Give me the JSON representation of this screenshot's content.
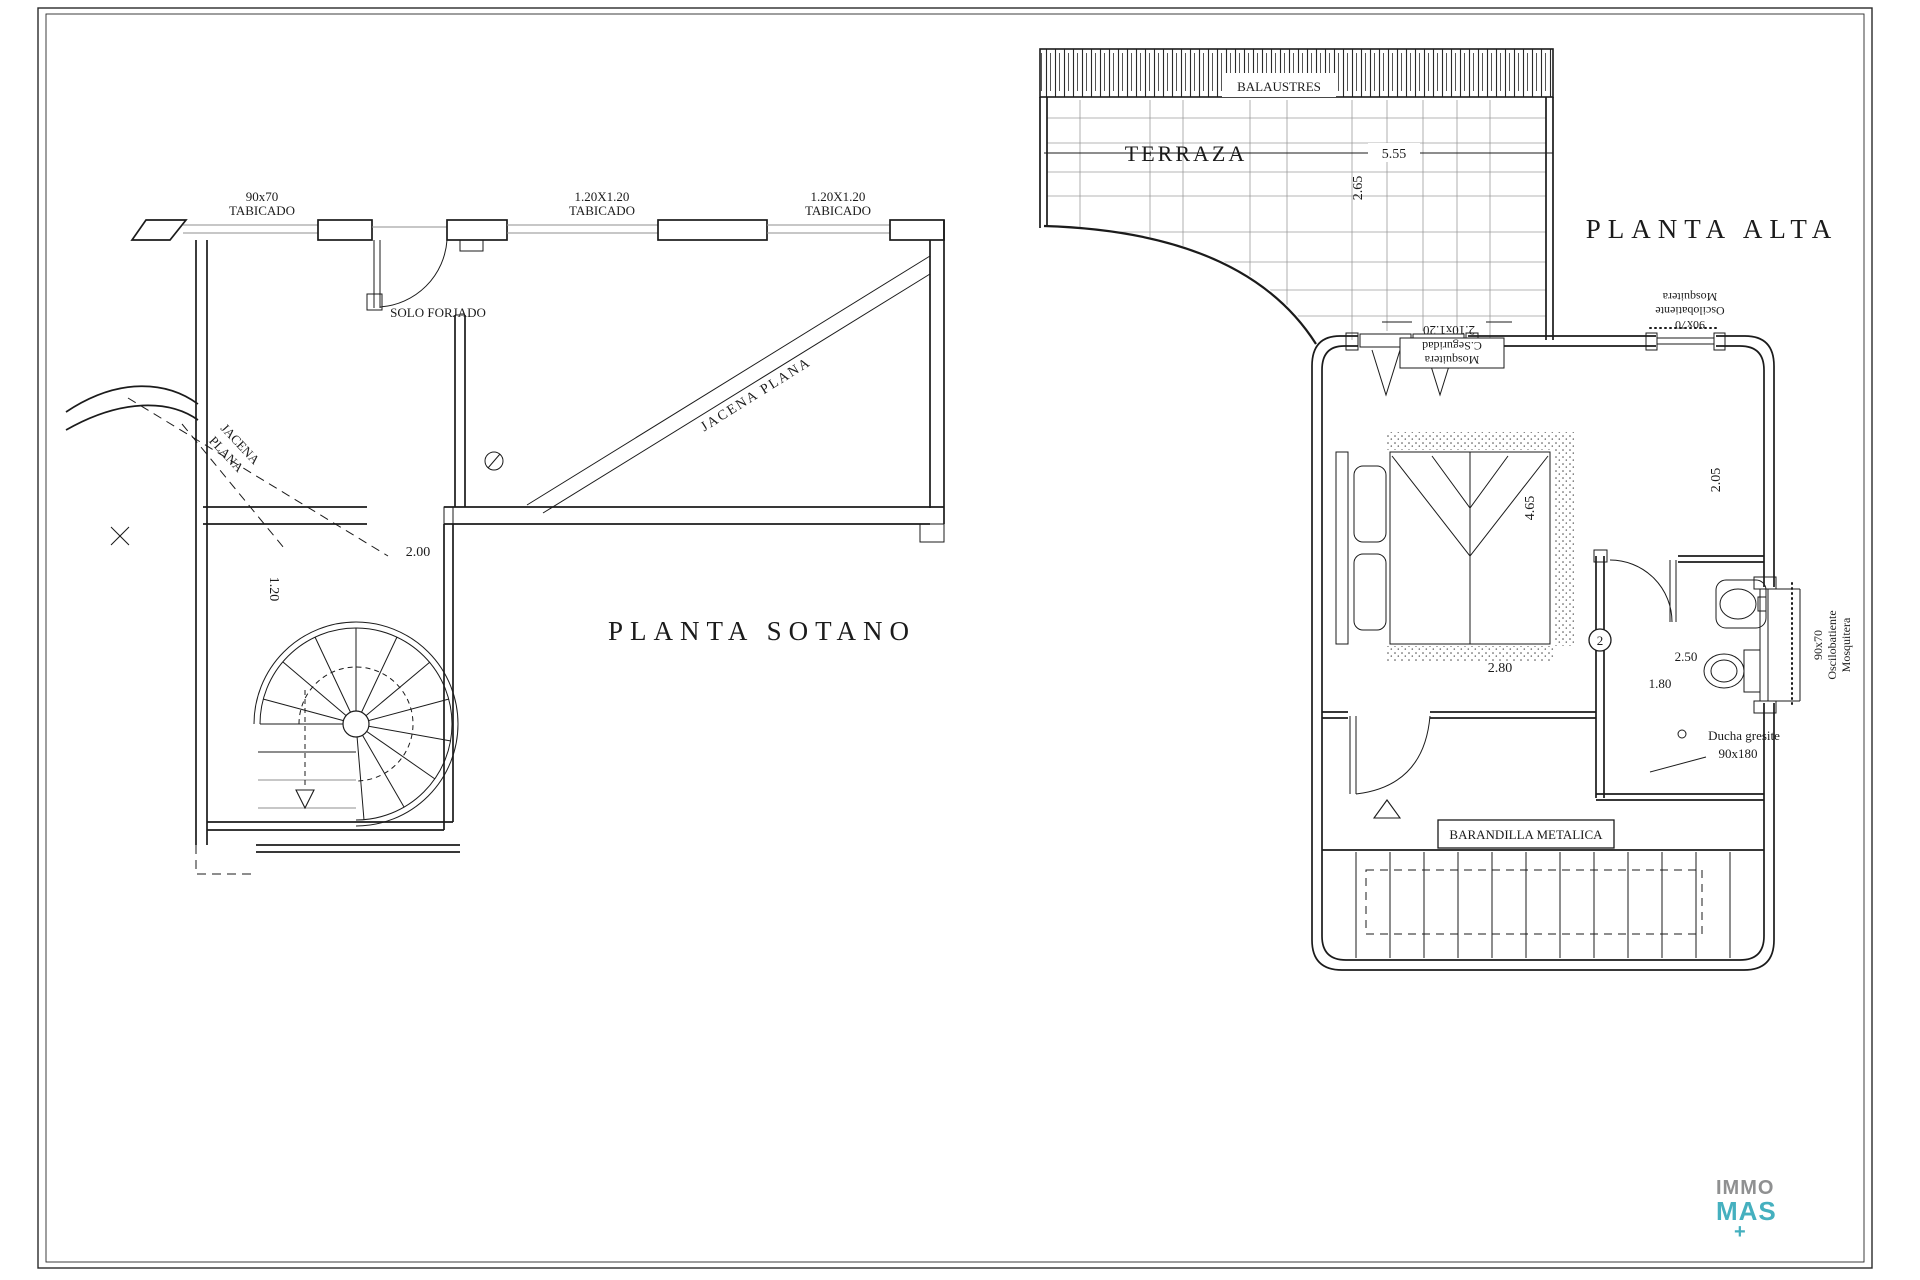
{
  "basement": {
    "title": "PLANTA  SOTANO",
    "labels": {
      "window_90x70": [
        "90x70",
        "TABICADO"
      ],
      "window_120_a": [
        "1.20X1.20",
        "TABICADO"
      ],
      "window_120_b": [
        "1.20X1.20",
        "TABICADO"
      ],
      "solo_forjado": "SOLO FORJADO",
      "jacena_left": [
        "JACENA",
        "PLANA"
      ],
      "jacena_right": "JACENA PLANA",
      "dim_opening": "2.00",
      "dim_corridor": "1.20"
    }
  },
  "upper": {
    "title": "PLANTA  ALTA",
    "labels": {
      "balaustres": "BALAUSTRES",
      "terraza": "TERRAZA",
      "dim_terrace_width": "5.55",
      "dim_terrace_depth": "2.65",
      "window_top_dim": "2.10x1.20",
      "mosquitera_seguridad": [
        "Mosquitera",
        "C.Seguridad"
      ],
      "osc_window_top": [
        "90x70",
        "Oscilobatiente",
        "Mosquitera"
      ],
      "osc_window_right": [
        "90x70",
        "Oscilobatiente",
        "Mosquitera"
      ],
      "dim_bed_height": "4.65",
      "dim_bed_width": "2.80",
      "dim_right_zone": "2.05",
      "dim_bath_a": "2.50",
      "dim_bath_b": "1.80",
      "bath_number": "2",
      "ducha": [
        "Ducha gresite",
        "90x180"
      ],
      "barandilla": "BARANDILLA METALICA"
    }
  },
  "logo": {
    "line1": "IMMO",
    "line2": "MAS",
    "plus": "+"
  }
}
